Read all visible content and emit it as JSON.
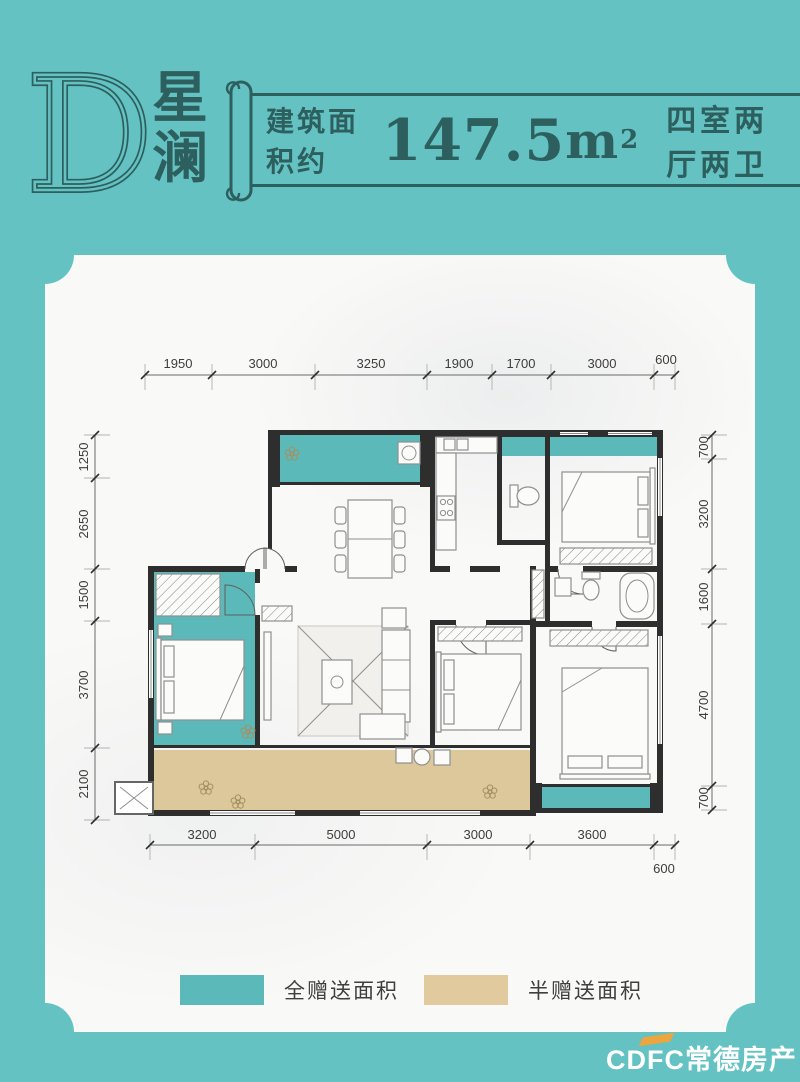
{
  "header": {
    "plan_letter": "D",
    "plan_name_char1": "星",
    "plan_name_char2": "澜",
    "area_label": "建筑面积约",
    "area_value": "147.5",
    "area_unit": "m",
    "area_exponent": "2",
    "rooms_label": "四室两厅两卫"
  },
  "floorplan": {
    "dimensions_mm": {
      "top": [
        "1950",
        "3000",
        "3250",
        "1900",
        "1700",
        "3000",
        "600"
      ],
      "bottom": [
        "3200",
        "5000",
        "3000",
        "3600",
        "600"
      ],
      "left": [
        "1250",
        "2650",
        "1500",
        "3700",
        "2100"
      ],
      "right": [
        "700",
        "3200",
        "1600",
        "4700",
        "700"
      ]
    },
    "colors": {
      "full_gift_area": "#5cb9ba",
      "half_gift_area": "#ddc89c",
      "wall": "#2e2e2e"
    }
  },
  "legend": {
    "items": [
      {
        "label": "全赠送面积",
        "color": "#5cb9ba"
      },
      {
        "label": "半赠送面积",
        "color": "#e0ca9e"
      }
    ]
  },
  "watermark": {
    "text": "CDFC常德房产"
  },
  "theme": {
    "background": "#64c2c3",
    "card": "#f9f9f7",
    "accent_dark": "#2d5f5e",
    "watermark_accent": "#eda53f"
  }
}
